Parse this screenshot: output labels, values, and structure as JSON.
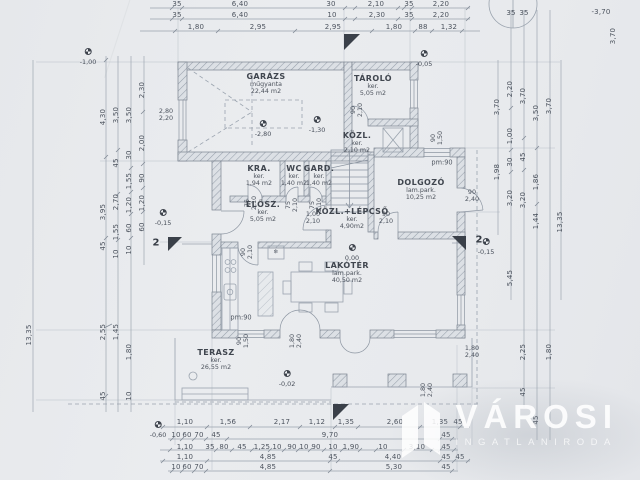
{
  "colors": {
    "paper": "#e9ebee",
    "line": "#8a94a0",
    "wall_fill": "#dde1e6",
    "text": "#4a515c",
    "marker": "#3a4049",
    "logo": "#ffffff"
  },
  "logo": {
    "title": "VÁROSI",
    "subtitle": "INGATLANIRODA"
  },
  "rooms": [
    {
      "name": "GARÁZS",
      "finish": "műgyanta",
      "area": "22,44 m2",
      "x": 266,
      "y": 72
    },
    {
      "name": "TÁROLÓ",
      "finish": "ker.",
      "area": "5,05 m2",
      "x": 373,
      "y": 74
    },
    {
      "name": "KÖZL.",
      "finish": "ker.",
      "area": "2,10 m2",
      "x": 357,
      "y": 131
    },
    {
      "name": "KRA.",
      "finish": "ker.",
      "area": "1,94 m2",
      "x": 259,
      "y": 164
    },
    {
      "name": "WC",
      "finish": "ker.",
      "area": "1,40 m2",
      "x": 294,
      "y": 164
    },
    {
      "name": "GARD.",
      "finish": "ker.",
      "area": "1,40 m2",
      "x": 319,
      "y": 164
    },
    {
      "name": "ELŐSZ.",
      "finish": "ker.",
      "area": "5,05 m2",
      "x": 263,
      "y": 200
    },
    {
      "name": "KÖZL.+LÉPCSŐ",
      "finish": "ker.",
      "area": "4,90m2",
      "x": 352,
      "y": 207
    },
    {
      "name": "DOLGOZÓ",
      "finish": "lam.park.",
      "area": "10,25 m2",
      "x": 421,
      "y": 178
    },
    {
      "name": "LAKÓTÉR",
      "finish": "lam.park.",
      "area": "40,50 m2",
      "x": 347,
      "y": 261
    },
    {
      "name": "TERASZ",
      "finish": "ker.",
      "area": "26,55 m2",
      "x": 216,
      "y": 348
    }
  ],
  "levels": [
    {
      "v": "-1,00",
      "x": 88,
      "y": 40
    },
    {
      "v": "-0,05",
      "x": 424,
      "y": 42
    },
    {
      "v": "-2,80",
      "x": 263,
      "y": 112
    },
    {
      "v": "-1,30",
      "x": 317,
      "y": 108
    },
    {
      "v": "0,00",
      "x": 352,
      "y": 236
    },
    {
      "v": "-0,15",
      "x": 163,
      "y": 201
    },
    {
      "v": "-0,15",
      "x": 486,
      "y": 230
    },
    {
      "v": "-0,02",
      "x": 287,
      "y": 362
    },
    {
      "v": "-0,60",
      "x": 158,
      "y": 413
    }
  ],
  "plan": {
    "texts": [
      {
        "t": "35",
        "x": 177,
        "y": 5,
        "c": "dim"
      },
      {
        "t": "6,40",
        "x": 240,
        "y": 5,
        "c": "dim"
      },
      {
        "t": "30",
        "x": 331,
        "y": 5,
        "c": "dim"
      },
      {
        "t": "2,10",
        "x": 376,
        "y": 5,
        "c": "dim"
      },
      {
        "t": "35",
        "x": 409,
        "y": 5,
        "c": "dim"
      },
      {
        "t": "2,20",
        "x": 441,
        "y": 5,
        "c": "dim"
      },
      {
        "t": "35",
        "x": 177,
        "y": 16,
        "c": "dim"
      },
      {
        "t": "6,40",
        "x": 240,
        "y": 16,
        "c": "dim"
      },
      {
        "t": "10",
        "x": 332,
        "y": 16,
        "c": "dim"
      },
      {
        "t": "2,30",
        "x": 377,
        "y": 16,
        "c": "dim"
      },
      {
        "t": "35",
        "x": 409,
        "y": 16,
        "c": "dim"
      },
      {
        "t": "2,20",
        "x": 441,
        "y": 16,
        "c": "dim"
      },
      {
        "t": "1,80",
        "x": 196,
        "y": 28,
        "c": "dim"
      },
      {
        "t": "2,95",
        "x": 258,
        "y": 28,
        "c": "dim"
      },
      {
        "t": "2,95",
        "x": 333,
        "y": 28,
        "c": "dim"
      },
      {
        "t": "1,80",
        "x": 394,
        "y": 28,
        "c": "dim"
      },
      {
        "t": "88",
        "x": 423,
        "y": 28,
        "c": "dim"
      },
      {
        "t": "1,32",
        "x": 449,
        "y": 28,
        "c": "dim"
      },
      {
        "t": "35",
        "x": 511,
        "y": 14,
        "c": "dim"
      },
      {
        "t": "35",
        "x": 524,
        "y": 14,
        "c": "dim"
      },
      {
        "t": "-3,70",
        "x": 601,
        "y": 13,
        "c": "dim"
      },
      {
        "t": "3,70",
        "x": 614,
        "y": 36,
        "c": "dim",
        "r": -90
      },
      {
        "t": "1,10",
        "x": 185,
        "y": 423,
        "c": "dim"
      },
      {
        "t": "1,56",
        "x": 228,
        "y": 423,
        "c": "dim"
      },
      {
        "t": "2,17",
        "x": 282,
        "y": 423,
        "c": "dim"
      },
      {
        "t": "1,12",
        "x": 317,
        "y": 423,
        "c": "dim"
      },
      {
        "t": "1,35",
        "x": 346,
        "y": 423,
        "c": "dim"
      },
      {
        "t": "2,60",
        "x": 395,
        "y": 423,
        "c": "dim"
      },
      {
        "t": "1,35",
        "x": 440,
        "y": 423,
        "c": "dim"
      },
      {
        "t": "45",
        "x": 458,
        "y": 423,
        "c": "dim"
      },
      {
        "t": "10",
        "x": 176,
        "y": 436,
        "c": "dim"
      },
      {
        "t": "60",
        "x": 187,
        "y": 436,
        "c": "dim"
      },
      {
        "t": "70",
        "x": 199,
        "y": 436,
        "c": "dim"
      },
      {
        "t": "45",
        "x": 216,
        "y": 436,
        "c": "dim"
      },
      {
        "t": "9,70",
        "x": 330,
        "y": 436,
        "c": "dim"
      },
      {
        "t": "45",
        "x": 446,
        "y": 436,
        "c": "dim"
      },
      {
        "t": "1,10",
        "x": 185,
        "y": 448,
        "c": "dim"
      },
      {
        "t": "35",
        "x": 210,
        "y": 448,
        "c": "dim"
      },
      {
        "t": "80",
        "x": 224,
        "y": 448,
        "c": "dim"
      },
      {
        "t": "45",
        "x": 242,
        "y": 448,
        "c": "dim"
      },
      {
        "t": "1,25",
        "x": 262,
        "y": 448,
        "c": "dim"
      },
      {
        "t": "10",
        "x": 277,
        "y": 448,
        "c": "dim"
      },
      {
        "t": "90",
        "x": 292,
        "y": 448,
        "c": "dim"
      },
      {
        "t": "10",
        "x": 304,
        "y": 448,
        "c": "dim"
      },
      {
        "t": "90",
        "x": 316,
        "y": 448,
        "c": "dim"
      },
      {
        "t": "10",
        "x": 333,
        "y": 448,
        "c": "dim"
      },
      {
        "t": "1,90",
        "x": 351,
        "y": 448,
        "c": "dim"
      },
      {
        "t": "10",
        "x": 383,
        "y": 448,
        "c": "dim"
      },
      {
        "t": "3,10",
        "x": 417,
        "y": 448,
        "c": "dim"
      },
      {
        "t": "45",
        "x": 446,
        "y": 448,
        "c": "dim"
      },
      {
        "t": "1,10",
        "x": 185,
        "y": 458,
        "c": "dim"
      },
      {
        "t": "4,85",
        "x": 268,
        "y": 458,
        "c": "dim"
      },
      {
        "t": "45",
        "x": 333,
        "y": 458,
        "c": "dim"
      },
      {
        "t": "4,40",
        "x": 393,
        "y": 458,
        "c": "dim"
      },
      {
        "t": "45",
        "x": 446,
        "y": 458,
        "c": "dim"
      },
      {
        "t": "45",
        "x": 460,
        "y": 458,
        "c": "dim"
      },
      {
        "t": "10",
        "x": 176,
        "y": 468,
        "c": "dim"
      },
      {
        "t": "60",
        "x": 187,
        "y": 468,
        "c": "dim"
      },
      {
        "t": "70",
        "x": 199,
        "y": 468,
        "c": "dim"
      },
      {
        "t": "4,85",
        "x": 268,
        "y": 468,
        "c": "dim"
      },
      {
        "t": "5,30",
        "x": 394,
        "y": 468,
        "c": "dim"
      },
      {
        "t": "45",
        "x": 446,
        "y": 468,
        "c": "dim"
      },
      {
        "t": "13,35",
        "x": 30,
        "y": 335,
        "c": "dim",
        "r": -90
      },
      {
        "t": "4,30",
        "x": 104,
        "y": 117,
        "c": "dim",
        "r": -90
      },
      {
        "t": "3,95",
        "x": 104,
        "y": 212,
        "c": "dim",
        "r": -90
      },
      {
        "t": "45",
        "x": 104,
        "y": 246,
        "c": "dim",
        "r": -90
      },
      {
        "t": "2,55",
        "x": 104,
        "y": 332,
        "c": "dim",
        "r": -90
      },
      {
        "t": "45",
        "x": 104,
        "y": 396,
        "c": "dim",
        "r": -90
      },
      {
        "t": "3,50",
        "x": 117,
        "y": 115,
        "c": "dim",
        "r": -90
      },
      {
        "t": "45",
        "x": 117,
        "y": 163,
        "c": "dim",
        "r": -90
      },
      {
        "t": "2,70",
        "x": 117,
        "y": 202,
        "c": "dim",
        "r": -90
      },
      {
        "t": "1,55",
        "x": 117,
        "y": 232,
        "c": "dim",
        "r": -90
      },
      {
        "t": "10",
        "x": 117,
        "y": 254,
        "c": "dim",
        "r": -90
      },
      {
        "t": "1,45",
        "x": 117,
        "y": 332,
        "c": "dim",
        "r": -90
      },
      {
        "t": "3,50",
        "x": 130,
        "y": 115,
        "c": "dim",
        "r": -90
      },
      {
        "t": "30",
        "x": 130,
        "y": 155,
        "c": "dim",
        "r": -90
      },
      {
        "t": "1,55",
        "x": 130,
        "y": 181,
        "c": "dim",
        "r": -90
      },
      {
        "t": "1,20",
        "x": 130,
        "y": 205,
        "c": "dim",
        "r": -90
      },
      {
        "t": "60",
        "x": 130,
        "y": 228,
        "c": "dim",
        "r": -90
      },
      {
        "t": "10",
        "x": 130,
        "y": 250,
        "c": "dim",
        "r": -90
      },
      {
        "t": "1,80",
        "x": 130,
        "y": 352,
        "c": "dim",
        "r": -90
      },
      {
        "t": "10",
        "x": 130,
        "y": 396,
        "c": "dim",
        "r": -90
      },
      {
        "t": "2,30",
        "x": 143,
        "y": 90,
        "c": "dim",
        "r": -90
      },
      {
        "t": "2,00",
        "x": 143,
        "y": 143,
        "c": "dim",
        "r": -90
      },
      {
        "t": "90",
        "x": 143,
        "y": 178,
        "c": "dim",
        "r": -90
      },
      {
        "t": "1,20",
        "x": 143,
        "y": 203,
        "c": "dim",
        "r": -90
      },
      {
        "t": "60",
        "x": 143,
        "y": 227,
        "c": "dim",
        "r": -90
      },
      {
        "t": "3,70",
        "x": 498,
        "y": 107,
        "c": "dim",
        "r": -90
      },
      {
        "t": "1,98",
        "x": 498,
        "y": 172,
        "c": "dim",
        "r": -90
      },
      {
        "t": "2,20",
        "x": 511,
        "y": 89,
        "c": "dim",
        "r": -90
      },
      {
        "t": "1,00",
        "x": 511,
        "y": 136,
        "c": "dim",
        "r": -90
      },
      {
        "t": "30",
        "x": 511,
        "y": 162,
        "c": "dim",
        "r": -90
      },
      {
        "t": "3,20",
        "x": 511,
        "y": 198,
        "c": "dim",
        "r": -90
      },
      {
        "t": "5,45",
        "x": 511,
        "y": 278,
        "c": "dim",
        "r": -90
      },
      {
        "t": "3,70",
        "x": 524,
        "y": 96,
        "c": "dim",
        "r": -90
      },
      {
        "t": "45",
        "x": 524,
        "y": 157,
        "c": "dim",
        "r": -90
      },
      {
        "t": "3,20",
        "x": 524,
        "y": 200,
        "c": "dim",
        "r": -90
      },
      {
        "t": "2,25",
        "x": 524,
        "y": 352,
        "c": "dim",
        "r": -90
      },
      {
        "t": "45",
        "x": 524,
        "y": 392,
        "c": "dim",
        "r": -90
      },
      {
        "t": "3,50",
        "x": 537,
        "y": 113,
        "c": "dim",
        "r": -90
      },
      {
        "t": "1,86",
        "x": 537,
        "y": 182,
        "c": "dim",
        "r": -90
      },
      {
        "t": "1,44",
        "x": 537,
        "y": 221,
        "c": "dim",
        "r": -90
      },
      {
        "t": "45",
        "x": 537,
        "y": 420,
        "c": "dim",
        "r": -90
      },
      {
        "t": "3,70",
        "x": 550,
        "y": 106,
        "c": "dim",
        "r": -90
      },
      {
        "t": "1,80",
        "x": 550,
        "y": 352,
        "c": "dim",
        "r": -90
      },
      {
        "t": "13,35",
        "x": 561,
        "y": 222,
        "c": "dim",
        "r": -90
      },
      {
        "t": "2,80/2,20",
        "x": 166,
        "y": 115,
        "c": "size"
      },
      {
        "t": "1,00/2,10",
        "x": 313,
        "y": 218,
        "c": "size"
      },
      {
        "t": "90/2,10",
        "x": 386,
        "y": 218,
        "c": "size"
      },
      {
        "t": "90/2,40",
        "x": 472,
        "y": 196,
        "c": "size"
      },
      {
        "t": "1,80/2,40",
        "x": 472,
        "y": 352,
        "c": "size"
      },
      {
        "t": "90/2,10",
        "x": 357,
        "y": 110,
        "c": "size",
        "r": -90
      },
      {
        "t": "90/1,50",
        "x": 437,
        "y": 138,
        "c": "size",
        "r": -90
      },
      {
        "t": "75/2,10",
        "x": 251,
        "y": 203,
        "c": "size",
        "r": -90
      },
      {
        "t": "75/2,10",
        "x": 292,
        "y": 205,
        "c": "size",
        "r": -90
      },
      {
        "t": "75/2,10",
        "x": 316,
        "y": 205,
        "c": "size",
        "r": -90
      },
      {
        "t": "90/2,10",
        "x": 247,
        "y": 252,
        "c": "size",
        "r": -90
      },
      {
        "t": "90/1,50",
        "x": 243,
        "y": 341,
        "c": "size",
        "r": -90
      },
      {
        "t": "1,80/2,40",
        "x": 296,
        "y": 341,
        "c": "size",
        "r": -90
      },
      {
        "t": "1,80/2,40",
        "x": 427,
        "y": 390,
        "c": "size",
        "r": -90
      },
      {
        "t": "pm:90",
        "x": 442,
        "y": 163,
        "c": "pm"
      },
      {
        "t": "pm:90",
        "x": 241,
        "y": 318,
        "c": "pm"
      },
      {
        "t": "2",
        "x": 156,
        "y": 243,
        "c": "sec"
      },
      {
        "t": "2",
        "x": 479,
        "y": 240,
        "c": "sec"
      },
      {
        "t": "❄",
        "x": 276,
        "y": 253,
        "c": "tiny"
      }
    ]
  }
}
